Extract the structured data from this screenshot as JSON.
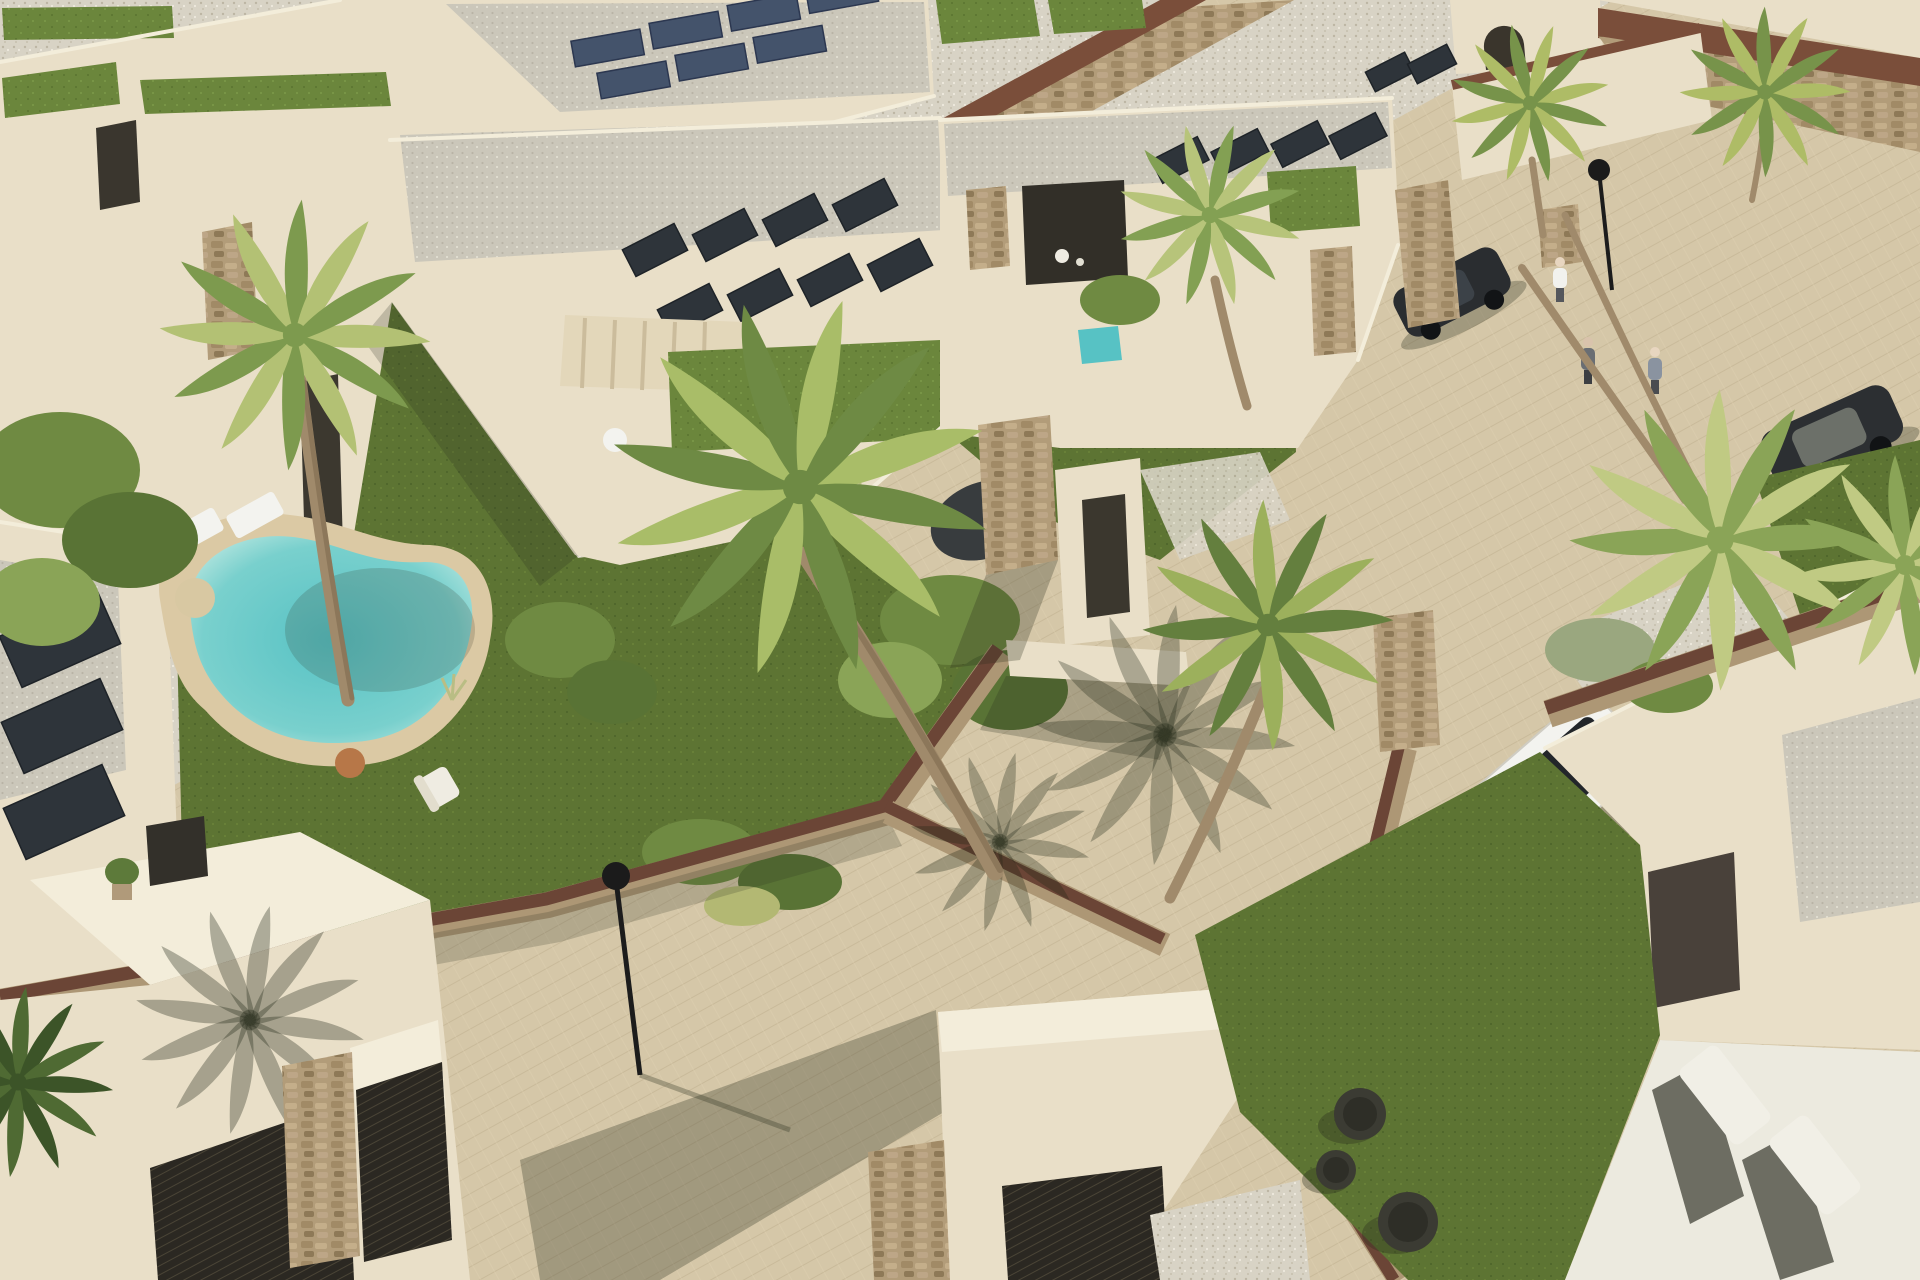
{
  "meta": {
    "description": "Aerial 3D architectural rendering of a modern Mediterranean villa development: flat-roofed cream villas with rooftop solar panels and green-roof sections, a kidney-shaped turquoise pool with sun loungers, stone-clad garden walls with rust-brown tops, palm trees, beige paved streets, a parked white SUV, two dark cars, pedestrians, street lamps, entrance gates and a large lawn with dark round poufs.",
    "type": "architectural-render",
    "width_px": 1920,
    "height_px": 1280
  },
  "colors": {
    "pavement": "#d5c7a8",
    "pavementLine": "#b7a685",
    "gravelLight": "#d8d3c5",
    "gravelGrey": "#cbc7ba",
    "cream": "#e9dfc8",
    "creamBright": "#f3edda",
    "creamShade": "#cdbfa2",
    "stone": "#b29c79",
    "mulch": "#6b4536",
    "rust": "#7a4e3a",
    "lawn": "#5d7433",
    "lawnBright": "#6b863c",
    "lawnDark": "#4c6329",
    "palmA": "#9cb05c",
    "palmB": "#6e8a44",
    "pool": "#57c2c4",
    "poolRim": "#bfe9e2",
    "deck": "#dbc9a4",
    "solarDark": "#2e343a",
    "solarBlue": "#44536b",
    "white": "#f3f3ef",
    "carDark": "#2a2d30",
    "gate": "#2b2822",
    "trunk": "#a08a6b",
    "shadow": "#2a2f1e"
  },
  "objects": {
    "villas": 9,
    "kidney_pool": 1,
    "plunge_pools": 2,
    "solar_panel_arrays": 5,
    "green_roof_sections": 7,
    "palm_trees": 10,
    "white_suv": 1,
    "dark_cars": 2,
    "pedestrians": 3,
    "street_lamps": 2,
    "sun_loungers": 4,
    "garden_poufs": 3,
    "entrance_gates": 3,
    "stone_piers": 6
  }
}
